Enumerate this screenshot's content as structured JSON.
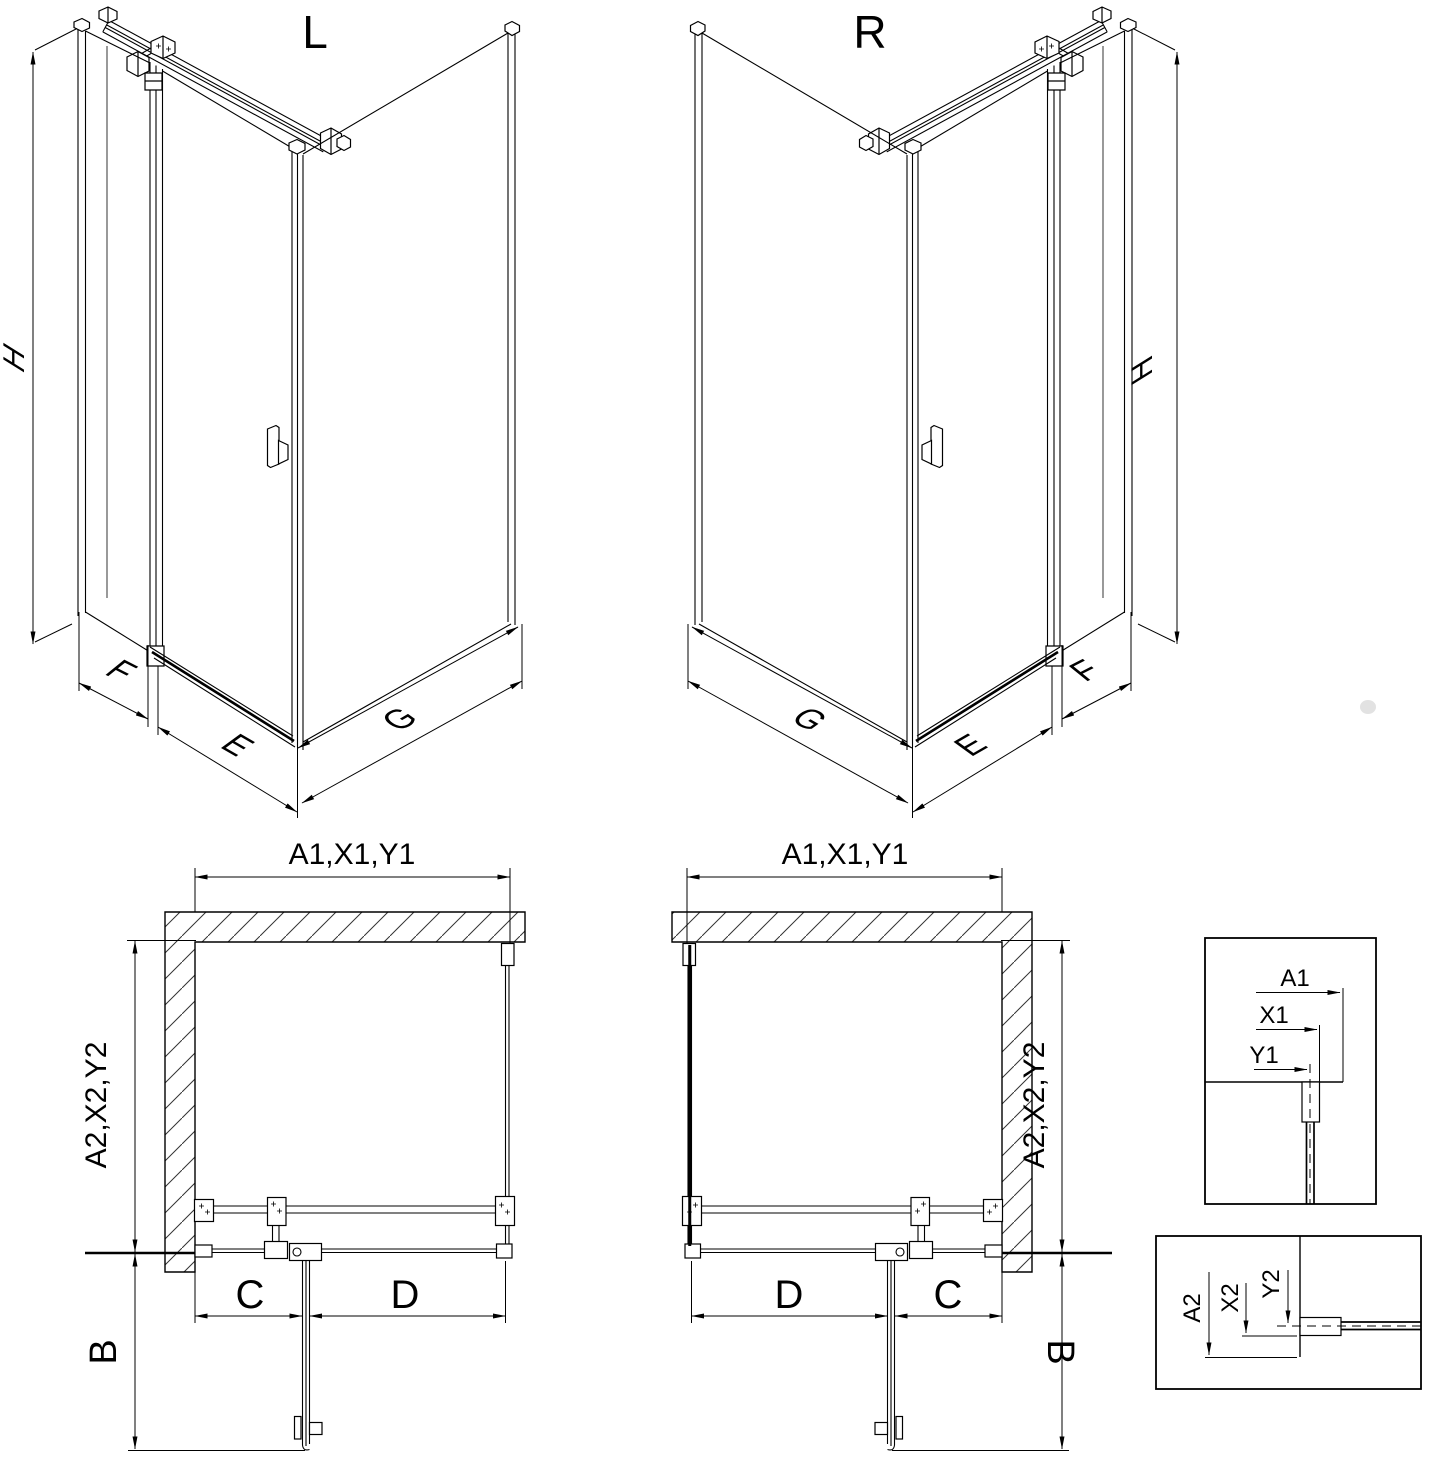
{
  "colors": {
    "line": "#000000",
    "background": "#ffffff",
    "hatch": "#333333"
  },
  "iso_left": {
    "title": "L",
    "dim_height": "H",
    "dim_side_panel": "F",
    "dim_door": "E",
    "dim_return_panel": "G"
  },
  "iso_right": {
    "title": "R",
    "dim_height": "H",
    "dim_side_panel": "F",
    "dim_door": "E",
    "dim_return_panel": "G"
  },
  "plan_left": {
    "dim_width": "A1,X1,Y1",
    "dim_depth": "A2,X2,Y2",
    "dim_door_swing": "B",
    "dim_fixed_segment": "C",
    "dim_door_width": "D"
  },
  "plan_right": {
    "dim_width": "A1,X1,Y1",
    "dim_depth": "A2,X2,Y2",
    "dim_door_swing": "B",
    "dim_fixed_segment": "C",
    "dim_door_width": "D"
  },
  "detail_width": {
    "labels": [
      "A1",
      "X1",
      "Y1"
    ]
  },
  "detail_depth": {
    "labels": [
      "A2",
      "X2",
      "Y2"
    ]
  }
}
